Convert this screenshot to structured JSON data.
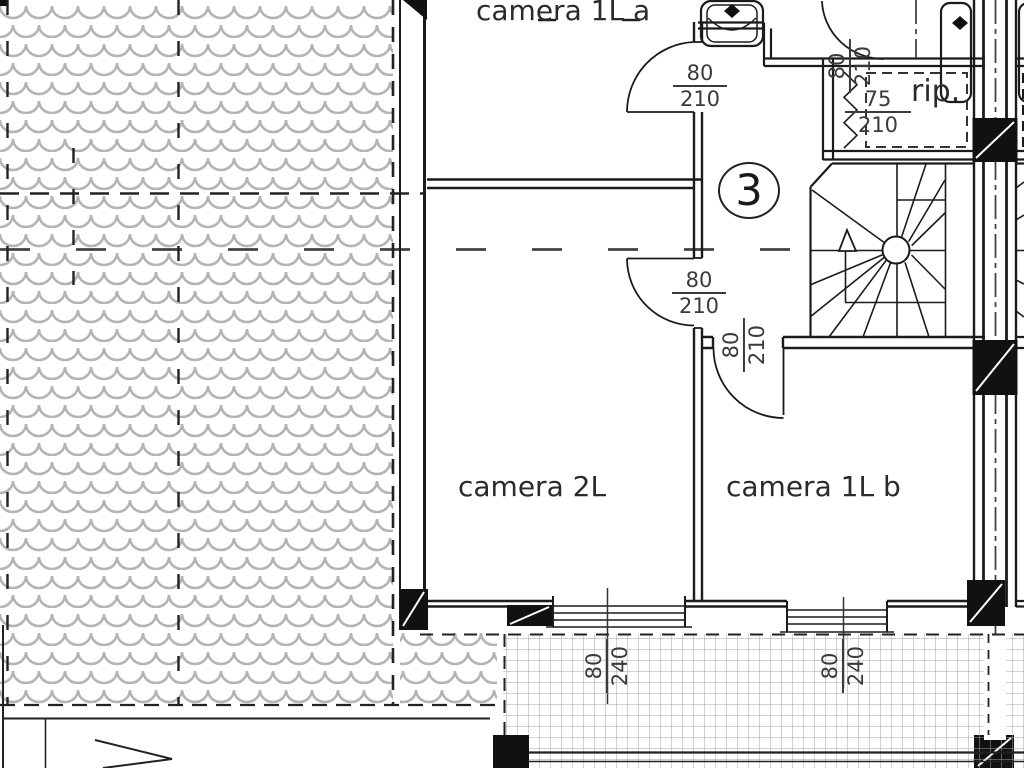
{
  "plan": {
    "unit_badge": "3",
    "rooms": {
      "camera_1l_a": "camera 1L a",
      "camera_2l": "camera 2L",
      "camera_1l_b": "camera 1L b",
      "rip": "rip."
    },
    "dimensions": {
      "door_camera_1l_a": {
        "num": "80",
        "den": "210"
      },
      "door_camera_2l": {
        "num": "80",
        "den": "210"
      },
      "door_camera_1l_b": {
        "num": "80",
        "den": "210"
      },
      "door_bath": {
        "num": "80",
        "den": "210"
      },
      "door_rip": {
        "num": "75",
        "den": "210"
      },
      "window_camera_2l": {
        "num": "80",
        "den": "240"
      },
      "window_camera_1l_b": {
        "num": "80",
        "den": "240"
      }
    },
    "colors": {
      "wall_line": "#1b1b1b",
      "roof_tile": "#b4b4b4",
      "balcony_grid": "#a3a3a3",
      "text": "#2b2b2b"
    }
  }
}
